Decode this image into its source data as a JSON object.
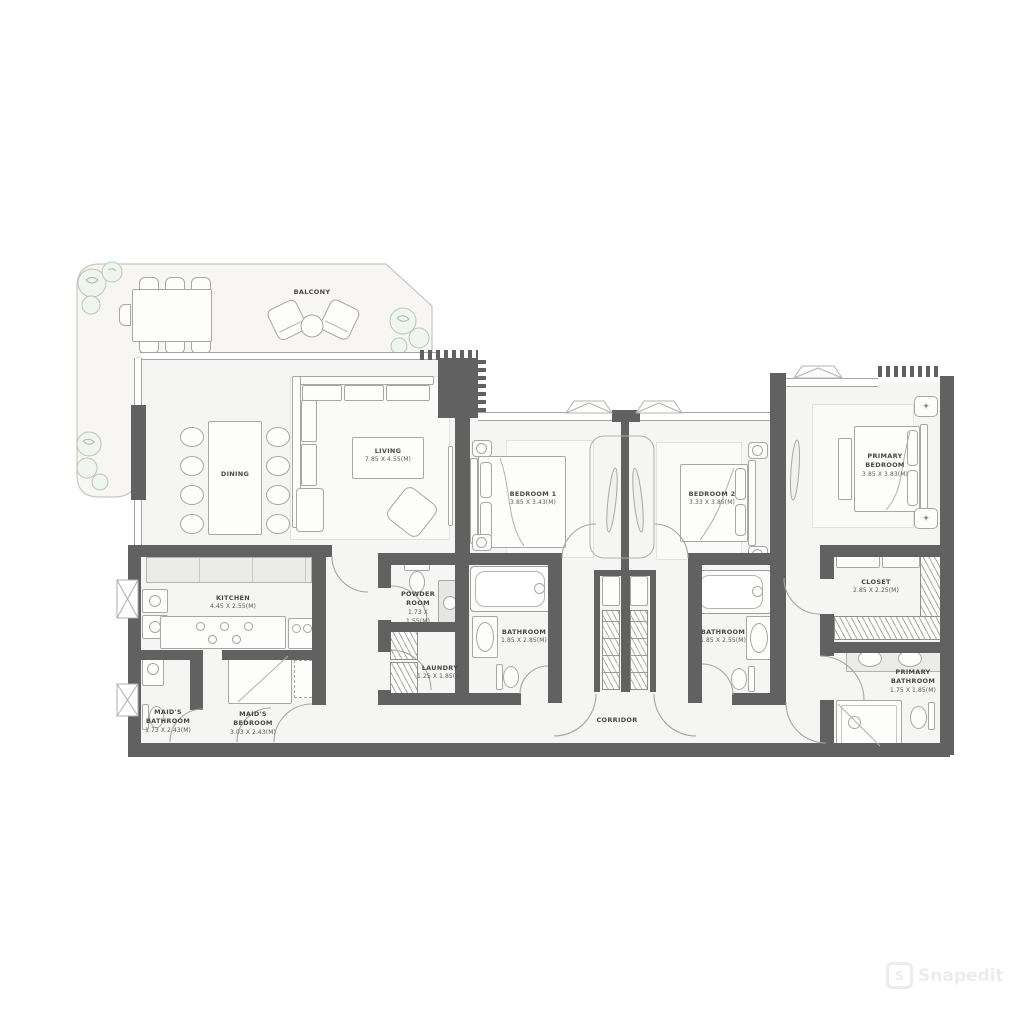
{
  "labels": {
    "balcony": {
      "name": "BALCONY"
    },
    "dining": {
      "name": "DINING"
    },
    "living": {
      "name": "LIVING",
      "dims": "7.85 X 4.55(M)"
    },
    "bedroom1": {
      "name": "BEDROOM 1",
      "dims": "3.85 X 3.43(M)"
    },
    "bedroom2": {
      "name": "BEDROOM 2",
      "dims": "3.33 X 3.85(M)"
    },
    "primary_bedroom": {
      "name": "PRIMARY BEDROOM",
      "dims": "3.85 X 3.83(M)"
    },
    "kitchen": {
      "name": "KITCHEN",
      "dims": "4.45 X 2.55(M)"
    },
    "powder_room": {
      "name": "POWDER ROOM",
      "dims": "1.73 X 1.55(M)"
    },
    "laundry": {
      "name": "LAUNDRY",
      "dims": "1.25 X 1.85(M)"
    },
    "bathroom1": {
      "name": "BATHROOM",
      "dims": "1.85 X 2.85(M)"
    },
    "bathroom2": {
      "name": "BATHROOM",
      "dims": "1.85 X 2.55(M)"
    },
    "closet": {
      "name": "CLOSET",
      "dims": "2.85 X 2.25(M)"
    },
    "primary_bathroom": {
      "name": "PRIMARY BATHROOM",
      "dims": "1.75 X 1.85(M)"
    },
    "maids_bathroom": {
      "name": "MAID'S BATHROOM",
      "dims": "1.73 X 2.43(M)"
    },
    "maids_bedroom": {
      "name": "MAID'S BEDROOM",
      "dims": "3.03 X 2.43(M)"
    },
    "corridor": {
      "name": "CORRIDOR"
    }
  },
  "watermark": {
    "text": "Snapedit",
    "initial": "S"
  },
  "colors": {
    "wall": "#616161",
    "floor": "#f5f5f3",
    "balcony": "#f8f6f2",
    "outline": "#a7a7a4",
    "plant": "#9fbf9a",
    "text": "#474747"
  }
}
